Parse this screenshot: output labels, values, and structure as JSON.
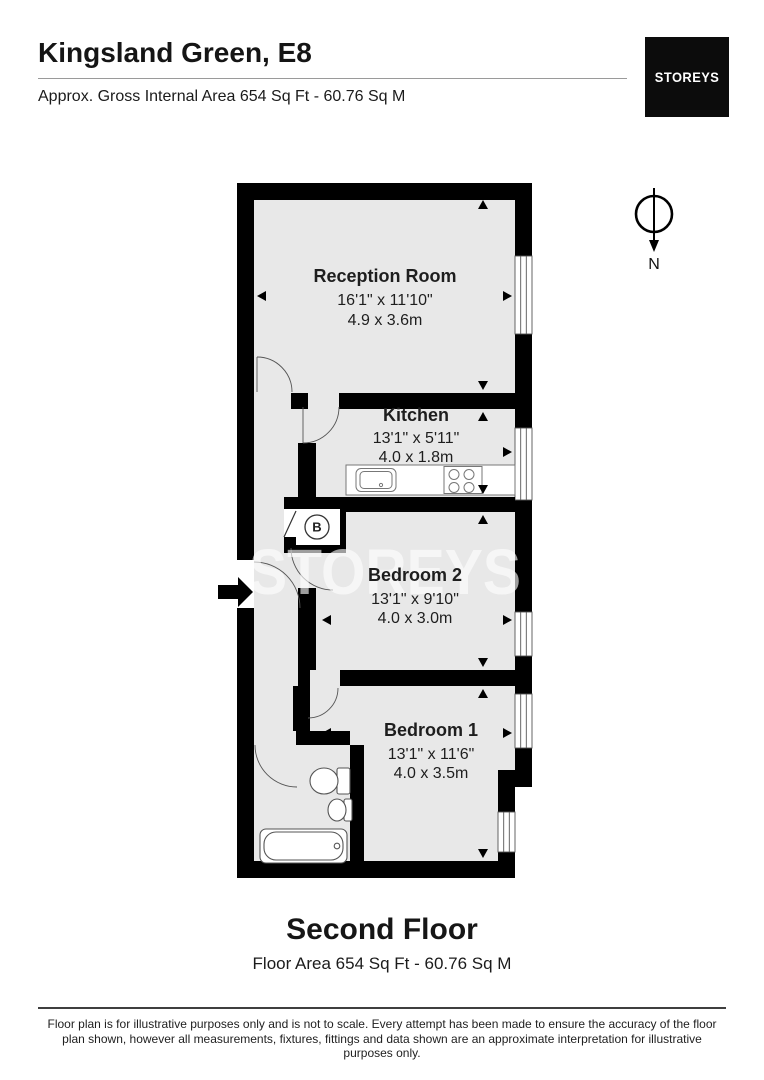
{
  "header": {
    "title": "Kingsland Green, E8",
    "subtitle": "Approx. Gross Internal Area 654 Sq Ft - 60.76 Sq M",
    "logo_text": "STOREYS"
  },
  "watermark": "STOREYS",
  "compass": {
    "label": "N"
  },
  "rooms": [
    {
      "name": "Reception Room",
      "imperial": "16'1\" x 11'10\"",
      "metric": "4.9 x 3.6m"
    },
    {
      "name": "Kitchen",
      "imperial": "13'1\" x 5'11\"",
      "metric": "4.0 x 1.8m"
    },
    {
      "name": "Bedroom 2",
      "imperial": "13'1\" x 9'10\"",
      "metric": "4.0 x 3.0m"
    },
    {
      "name": "Bedroom 1",
      "imperial": "13'1\" x 11'6\"",
      "metric": "4.0 x 3.5m"
    }
  ],
  "fixtures": {
    "boiler_label": "B"
  },
  "floor": {
    "name": "Second Floor",
    "area": "Floor Area 654 Sq Ft - 60.76 Sq M"
  },
  "footer": {
    "disclaimer": "Floor plan is for illustrative purposes only and is not to scale. Every attempt has been made to ensure the accuracy of the floor plan shown, however all measurements, fixtures, fittings and data shown are an approximate interpretation for illustrative purposes only."
  },
  "colors": {
    "wall": "#000000",
    "floor_fill": "#e8e8e8",
    "logo_bg": "#0c0c0c"
  }
}
